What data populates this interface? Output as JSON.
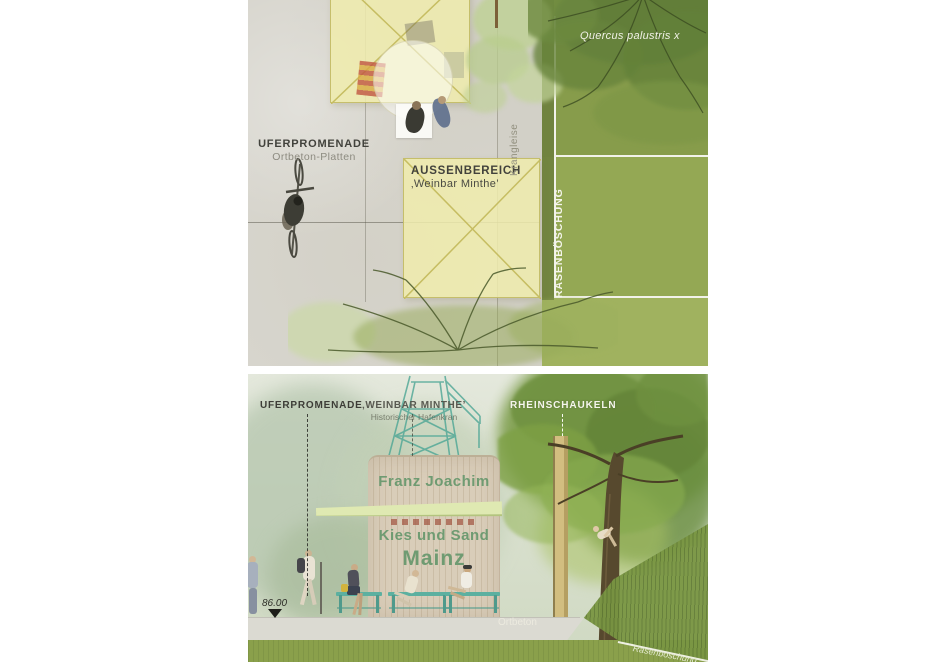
{
  "plan": {
    "labels": {
      "promenade_title": "UFERPROMENADE",
      "promenade_sub": "Ortbeton-Platten",
      "outdoor_area_title": "AUSSENBEREICH",
      "outdoor_area_sub": "‚Weinbar Minthe’",
      "crane_tracks": "Krangleise",
      "lawn_slope": "RASENBÖSCHUNG",
      "tree_species": "Quercus palustris x"
    }
  },
  "section": {
    "labels": {
      "promenade_title": "UFERPROMENADE",
      "weinbar_title": "‚WEINBAR MINTHE’",
      "weinbar_sub": "Historischer Hafenkran",
      "swings_title": "RHEINSCHAUKELN",
      "elevation": "86.00",
      "ground_material": "Ortbeton",
      "slope_label": "Rasenböschung"
    },
    "kiosk_sign": {
      "line1": "Franz Joachim",
      "line2": "Kies und Sand",
      "line3": "Mainz"
    }
  },
  "colors": {
    "promenade": "#d7d5cd",
    "lawn": "#94a854",
    "umbrella": "#f0ecad",
    "crane_teal": "#4da695",
    "bench_teal": "#5cb0a0",
    "kiosk_wall": "#d9cdb9",
    "kiosk_text_green": "#6f9b72",
    "canopy": "#dfe9b2",
    "concrete": "#dbdad2",
    "grass_band": "#8aa04b"
  }
}
